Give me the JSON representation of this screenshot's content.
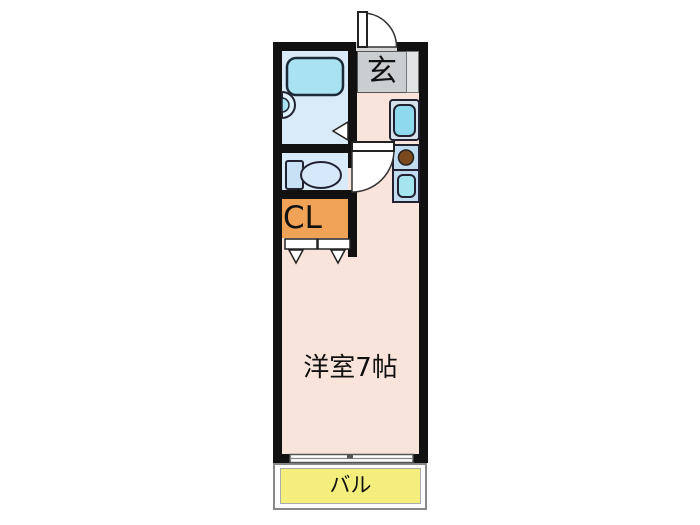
{
  "floorplan": {
    "type": "apartment-floor-plan",
    "labels": {
      "entrance": "玄",
      "closet": "CL",
      "main_room": "洋室7帖",
      "balcony": "バル"
    },
    "rooms": [
      {
        "name": "entrance",
        "label": "玄",
        "color": "#CBCED0"
      },
      {
        "name": "bathroom",
        "label": "",
        "color": "#D9EAF8"
      },
      {
        "name": "toilet-room",
        "label": "",
        "color": "#D9EAF8"
      },
      {
        "name": "closet",
        "label": "CL",
        "color": "#F0A257"
      },
      {
        "name": "main-room",
        "label": "洋室7帖",
        "color": "#F9E4DB"
      },
      {
        "name": "balcony",
        "label": "バル",
        "color": "#F4EF7D"
      }
    ],
    "fixtures": [
      "bathtub",
      "washbasin",
      "bathroom-door-mark",
      "toilet",
      "entrance-door-swing",
      "interior-door-swing",
      "shoe-cabinet",
      "washing-machine-pan",
      "stove-burner",
      "kitchen-sink",
      "closet-bifold-doors",
      "sliding-window"
    ],
    "colors": {
      "wall": "#111111",
      "main_room_pink": "#F9E4DB",
      "wet_area_blue": "#D9EAF8",
      "fixture_cyan": "#A9E3F2",
      "closet_orange": "#F0A257",
      "entrance_gray": "#CBCED0",
      "balcony_yellow": "#F4EF7D",
      "burner_brown": "#7A4A1E"
    }
  }
}
